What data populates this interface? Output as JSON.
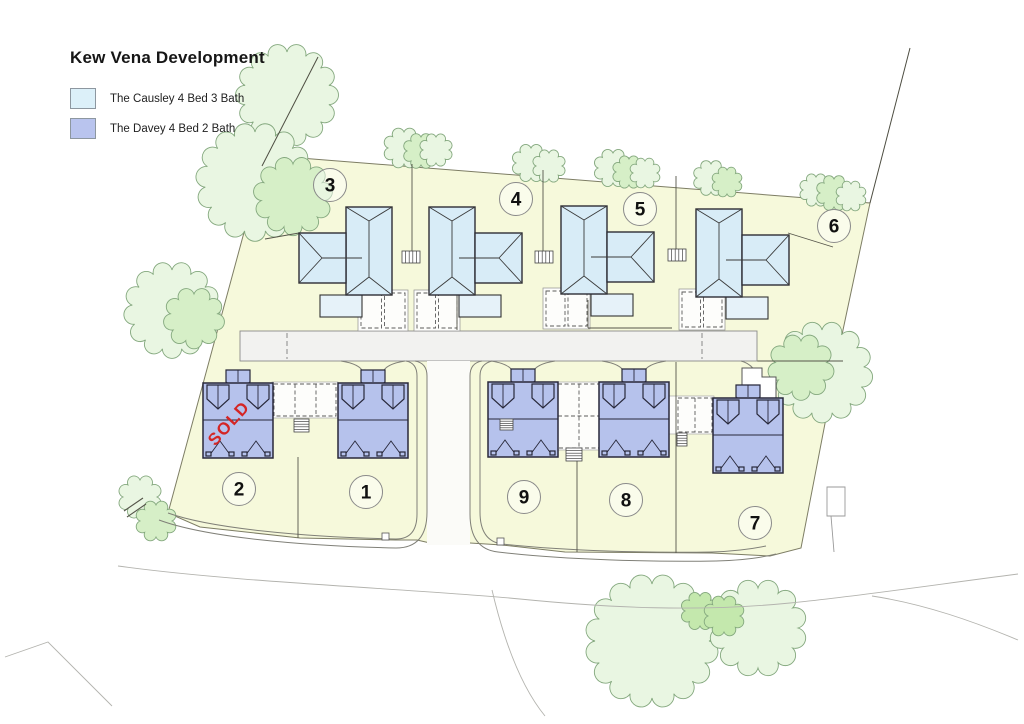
{
  "title": "Kew Vena Development",
  "legend": {
    "items": [
      {
        "id": "causley",
        "label": "The Causley 4 Bed 3 Bath",
        "color": "#dcf0f9"
      },
      {
        "id": "davey",
        "label": "The Davey 4 Bed 2 Bath",
        "color": "#b9c4ee"
      }
    ]
  },
  "sold_label": "SOLD",
  "plots": [
    {
      "number": "3",
      "type": "causley",
      "sold": false
    },
    {
      "number": "4",
      "type": "causley",
      "sold": false
    },
    {
      "number": "5",
      "type": "causley",
      "sold": false
    },
    {
      "number": "6",
      "type": "causley",
      "sold": false
    },
    {
      "number": "2",
      "type": "davey",
      "sold": true
    },
    {
      "number": "1",
      "type": "davey",
      "sold": false
    },
    {
      "number": "9",
      "type": "davey",
      "sold": false
    },
    {
      "number": "8",
      "type": "davey",
      "sold": false
    },
    {
      "number": "7",
      "type": "davey",
      "sold": false
    }
  ],
  "colors": {
    "causley_house": "#d8ecf7",
    "causley_ext": "#e6f2f9",
    "davey_house": "#b6c2ec",
    "site": "#f6f9db",
    "road": "#f2f2f0",
    "drive": "#fdfdfb",
    "tree_light": "#e9f6e2",
    "tree_mid": "#d6efc7",
    "tree_dark": "#c4e8ad",
    "sold_text": "#d42525"
  }
}
